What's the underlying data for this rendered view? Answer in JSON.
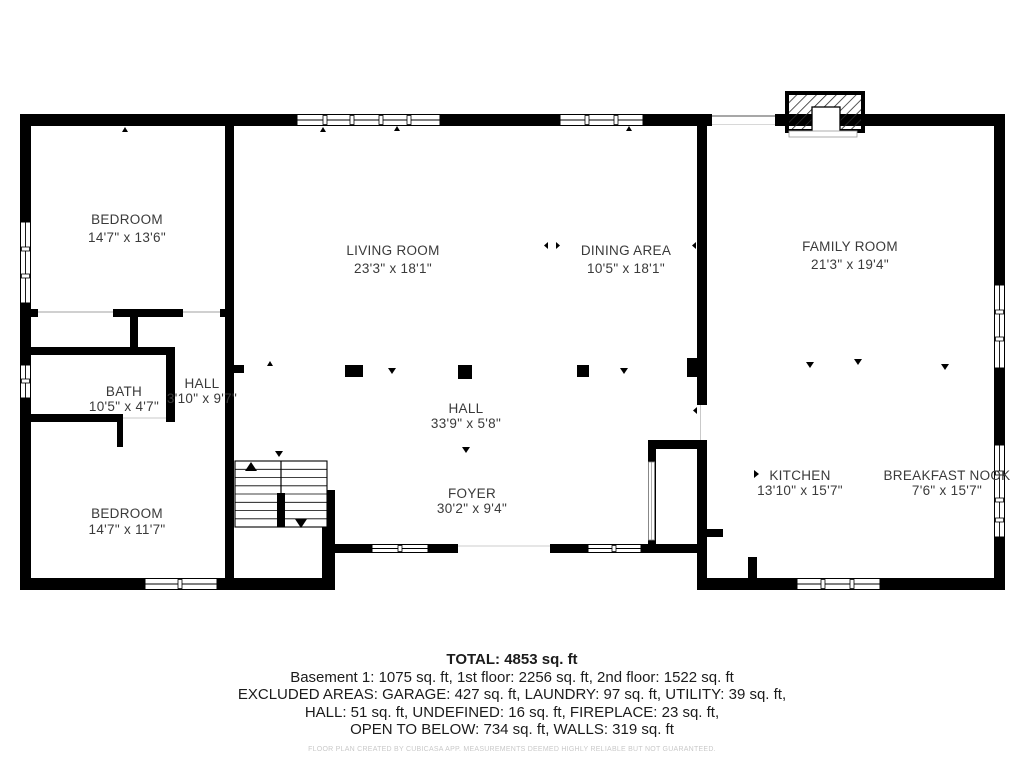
{
  "floor_plan": {
    "rooms": [
      {
        "name": "BEDROOM",
        "dims": "14'7\" x 13'6\""
      },
      {
        "name": "LIVING ROOM",
        "dims": "23'3\" x 18'1\""
      },
      {
        "name": "DINING AREA",
        "dims": "10'5\" x 18'1\""
      },
      {
        "name": "FAMILY ROOM",
        "dims": "21'3\" x 19'4\""
      },
      {
        "name": "BATH",
        "dims": "10'5\" x 4'7\""
      },
      {
        "name": "HALL",
        "dims": "3'10\" x 9'7\""
      },
      {
        "name": "HALL",
        "dims": "33'9\" x 5'8\""
      },
      {
        "name": "BEDROOM",
        "dims": "14'7\" x 11'7\""
      },
      {
        "name": "FOYER",
        "dims": "30'2\" x 9'4\""
      },
      {
        "name": "KITCHEN",
        "dims": "13'10\" x 15'7\""
      },
      {
        "name": "BREAKFAST NOOK",
        "dims": "7'6\" x 15'7\""
      }
    ],
    "features": [
      "fireplace",
      "u-shaped-staircase",
      "basement-stairwell"
    ]
  },
  "summary": {
    "total": "TOTAL: 4853 sq. ft",
    "line1": "Basement 1: 1075 sq. ft, 1st floor: 2256 sq. ft, 2nd floor: 1522 sq. ft",
    "line2": "EXCLUDED AREAS: GARAGE: 427 sq. ft, LAUNDRY: 97 sq. ft, UTILITY: 39 sq. ft,",
    "line3": "HALL: 51 sq. ft, UNDEFINED: 16 sq. ft, FIREPLACE: 23 sq. ft,",
    "line4": "OPEN TO BELOW: 734 sq. ft, WALLS: 319 sq. ft"
  },
  "footer": {
    "disclaimer": "FLOOR PLAN CREATED BY CUBICASA APP. MEASUREMENTS DEEMED HIGHLY RELIABLE BUT NOT GUARANTEED."
  },
  "colors": {
    "wall": "#000000",
    "background": "#ffffff",
    "room_text": "#3a3a3a",
    "summary_text": "#1b1b1b",
    "fine_print": "#c9c9c9"
  }
}
